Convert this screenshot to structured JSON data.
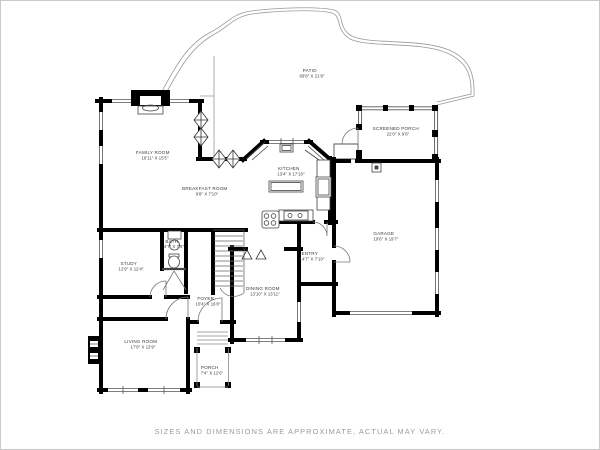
{
  "title": "First floor plan",
  "disclaimer": "SIZES AND DIMENSIONS ARE APPROXIMATE, ACTUAL MAY VARY.",
  "colors": {
    "wall": "#000000",
    "thin_line": "#555555",
    "door_line": "#777777",
    "patio_line": "#999999",
    "label_text": "#3a3a3a",
    "disclaimer_text": "#9a9a9a",
    "page_border": "#c9c9c9",
    "background": "#ffffff"
  },
  "rooms": [
    {
      "id": "patio",
      "name": "PATIO",
      "dims": "69'8\" X 21'9\""
    },
    {
      "id": "family-room",
      "name": "FAMILY ROOM",
      "dims": "19'11\" X 15'5\""
    },
    {
      "id": "breakfast-room",
      "name": "BREAKFAST ROOM",
      "dims": "9'8\" X 7'10\""
    },
    {
      "id": "kitchen",
      "name": "KITCHEN",
      "dims": "13'4\" X 17'10\""
    },
    {
      "id": "screened-porch",
      "name": "SCREENED PORCH",
      "dims": "22'0\" X 9'6\""
    },
    {
      "id": "garage",
      "name": "GARAGE",
      "dims": "19'6\" X 19'7\""
    },
    {
      "id": "bath",
      "name": "BATH",
      "dims": "4'7\" X 7'6\""
    },
    {
      "id": "study",
      "name": "STUDY",
      "dims": "12'9\" X 12'4\""
    },
    {
      "id": "foyer",
      "name": "FOYER",
      "dims": "10'4\" X 16'8\""
    },
    {
      "id": "dining-room",
      "name": "DINING ROOM",
      "dims": "13'10\" X 13'11\""
    },
    {
      "id": "entry",
      "name": "ENTRY",
      "dims": "14'7\" X 7'10\""
    },
    {
      "id": "living-room",
      "name": "LIVING ROOM",
      "dims": "17'8\" X 13'9\""
    },
    {
      "id": "porch",
      "name": "PORCH",
      "dims": "7'4\" X 12'6\""
    }
  ]
}
